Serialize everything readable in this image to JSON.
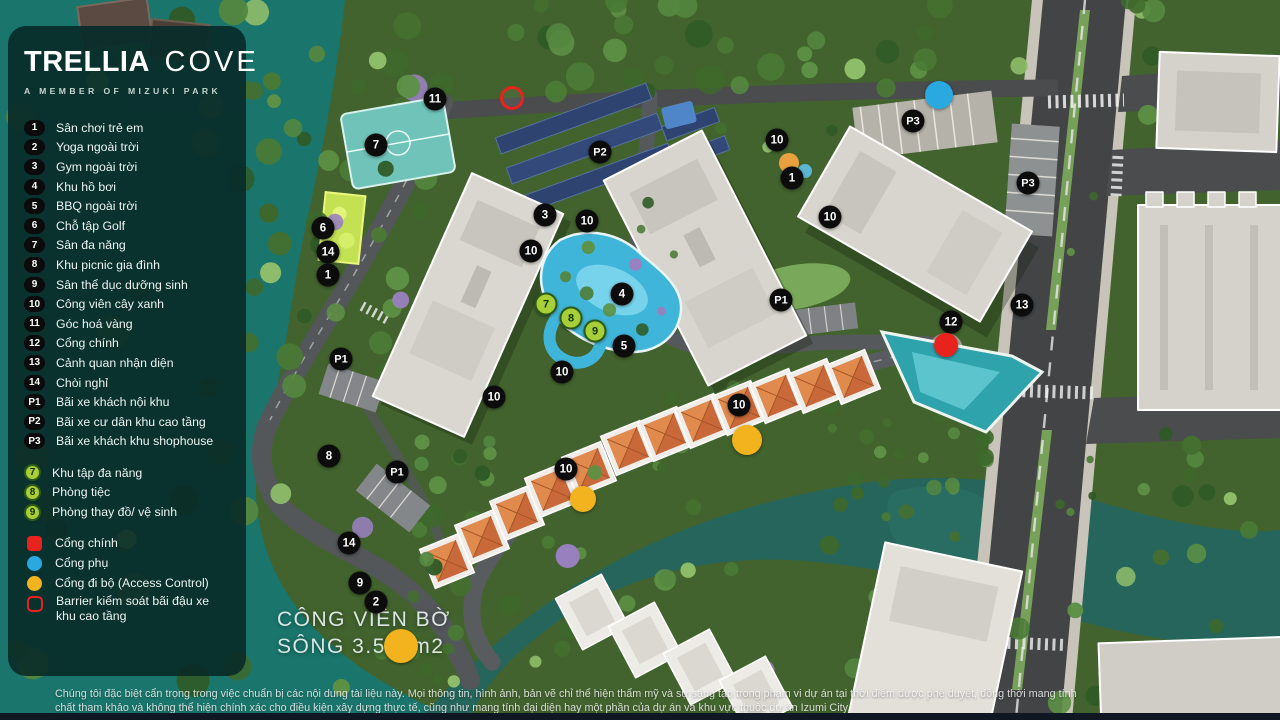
{
  "brand": {
    "title_primary": "TRELLIA",
    "title_secondary": "COVE",
    "subtitle": "A MEMBER OF MIZUKI PARK"
  },
  "colors": {
    "panel_teal": "#082c2a",
    "badge_black": "#0b0b0b",
    "marker_green": "#a8ce38",
    "marker_green_border": "#2c5b17",
    "gate_red": "#e8231d",
    "gate_blue": "#2aa9e0",
    "gate_yellow": "#f2b31e"
  },
  "legend": {
    "numbered_items": [
      {
        "id": "1",
        "label": "Sân chơi trẻ em"
      },
      {
        "id": "2",
        "label": "Yoga ngoài trời"
      },
      {
        "id": "3",
        "label": "Gym ngoài trời"
      },
      {
        "id": "4",
        "label": "Khu hồ bơi"
      },
      {
        "id": "5",
        "label": "BBQ ngoài trời"
      },
      {
        "id": "6",
        "label": "Chỗ tập Golf"
      },
      {
        "id": "7",
        "label": "Sân đa năng"
      },
      {
        "id": "8",
        "label": "Khu picnic gia đình"
      },
      {
        "id": "9",
        "label": "Sân thể dục dưỡng sinh"
      },
      {
        "id": "10",
        "label": "Công viên cây xanh"
      },
      {
        "id": "11",
        "label": "Góc hoá vàng"
      },
      {
        "id": "12",
        "label": "Cổng chính"
      },
      {
        "id": "13",
        "label": "Cảnh quan nhận diện"
      },
      {
        "id": "14",
        "label": "Chòi nghỉ"
      },
      {
        "id": "P1",
        "label": "Bãi xe khách nội khu"
      },
      {
        "id": "P2",
        "label": "Bãi xe cư dân khu cao tầng"
      },
      {
        "id": "P3",
        "label": "Bãi xe khách khu shophouse"
      }
    ],
    "green_items": [
      {
        "id": "7",
        "label": "Khu tập đa năng"
      },
      {
        "id": "8",
        "label": "Phòng tiệc"
      },
      {
        "id": "9",
        "label": "Phòng thay đồ/ vệ sinh"
      }
    ],
    "gate_items": [
      {
        "type": "red",
        "label": "Cổng chính"
      },
      {
        "type": "blue",
        "label": "Cổng phụ"
      },
      {
        "type": "yellow",
        "label": "Cổng đi bộ (Access Control)"
      },
      {
        "type": "barrier",
        "label": "Barrier kiểm soát bãi đậu xe khu cao tầng",
        "label_line1": "Barrier kiểm soát bãi đậu xe",
        "label_line2": "khu cao tầng"
      }
    ]
  },
  "map": {
    "area_label": {
      "line1": "CÔNG VIÊN BỜ",
      "line2": "SÔNG 3.500m2",
      "x": 277,
      "y": 606
    },
    "markers": [
      {
        "type": "num",
        "label": "11",
        "x": 435,
        "y": 99
      },
      {
        "type": "barrier",
        "label": "",
        "x": 512,
        "y": 98
      },
      {
        "type": "num",
        "label": "7",
        "x": 376,
        "y": 145
      },
      {
        "type": "p",
        "label": "P2",
        "x": 600,
        "y": 152
      },
      {
        "type": "num",
        "label": "10",
        "x": 777,
        "y": 140
      },
      {
        "type": "num",
        "label": "1",
        "x": 792,
        "y": 178
      },
      {
        "type": "p",
        "label": "P3",
        "x": 913,
        "y": 121
      },
      {
        "type": "blue",
        "label": "",
        "x": 939,
        "y": 95
      },
      {
        "type": "p",
        "label": "P3",
        "x": 1028,
        "y": 183
      },
      {
        "type": "num",
        "label": "6",
        "x": 323,
        "y": 228
      },
      {
        "type": "num",
        "label": "14",
        "x": 328,
        "y": 252
      },
      {
        "type": "num",
        "label": "1",
        "x": 328,
        "y": 275
      },
      {
        "type": "num",
        "label": "3",
        "x": 545,
        "y": 215
      },
      {
        "type": "num",
        "label": "10",
        "x": 587,
        "y": 221
      },
      {
        "type": "num",
        "label": "10",
        "x": 531,
        "y": 251
      },
      {
        "type": "num",
        "label": "10",
        "x": 830,
        "y": 217
      },
      {
        "type": "num",
        "label": "4",
        "x": 622,
        "y": 294
      },
      {
        "type": "green",
        "label": "7",
        "x": 546,
        "y": 304
      },
      {
        "type": "green",
        "label": "8",
        "x": 571,
        "y": 318
      },
      {
        "type": "green",
        "label": "9",
        "x": 595,
        "y": 331
      },
      {
        "type": "num",
        "label": "5",
        "x": 624,
        "y": 346
      },
      {
        "type": "p",
        "label": "P1",
        "x": 341,
        "y": 359
      },
      {
        "type": "num",
        "label": "10",
        "x": 562,
        "y": 372
      },
      {
        "type": "num",
        "label": "10",
        "x": 494,
        "y": 397
      },
      {
        "type": "p",
        "label": "P1",
        "x": 781,
        "y": 300
      },
      {
        "type": "num",
        "label": "13",
        "x": 1022,
        "y": 305
      },
      {
        "type": "num",
        "label": "12",
        "x": 951,
        "y": 322
      },
      {
        "type": "red",
        "label": "",
        "x": 946,
        "y": 345
      },
      {
        "type": "num",
        "label": "10",
        "x": 739,
        "y": 405
      },
      {
        "type": "yellow",
        "label": "",
        "x": 747,
        "y": 440,
        "size": 30
      },
      {
        "type": "num",
        "label": "8",
        "x": 329,
        "y": 456
      },
      {
        "type": "p",
        "label": "P1",
        "x": 397,
        "y": 472
      },
      {
        "type": "num",
        "label": "10",
        "x": 566,
        "y": 469
      },
      {
        "type": "yellow",
        "label": "",
        "x": 583,
        "y": 499,
        "size": 26
      },
      {
        "type": "num",
        "label": "14",
        "x": 349,
        "y": 543
      },
      {
        "type": "num",
        "label": "9",
        "x": 360,
        "y": 583
      },
      {
        "type": "num",
        "label": "2",
        "x": 376,
        "y": 602
      },
      {
        "type": "yellow",
        "label": "",
        "x": 401,
        "y": 646,
        "size": 34
      }
    ]
  },
  "disclaimer": {
    "line1": "Chúng tôi đặc biệt cẩn trọng trong việc chuẩn bị các nội dung tài liệu này. Mọi thông tin, hình ảnh, bản vẽ chỉ thể hiện thẩm mỹ và sự sáng tạo trong phạm vi dự án tại thời điểm được phê duyệt, đồng thời mang tính",
    "line2": "chất tham khảo và không thể hiện chính xác cho điều kiện xây dựng thực tế, cũng như mang tính đại diện hay một phần của dự án và khu vực thuộc dự án Izumi City."
  }
}
